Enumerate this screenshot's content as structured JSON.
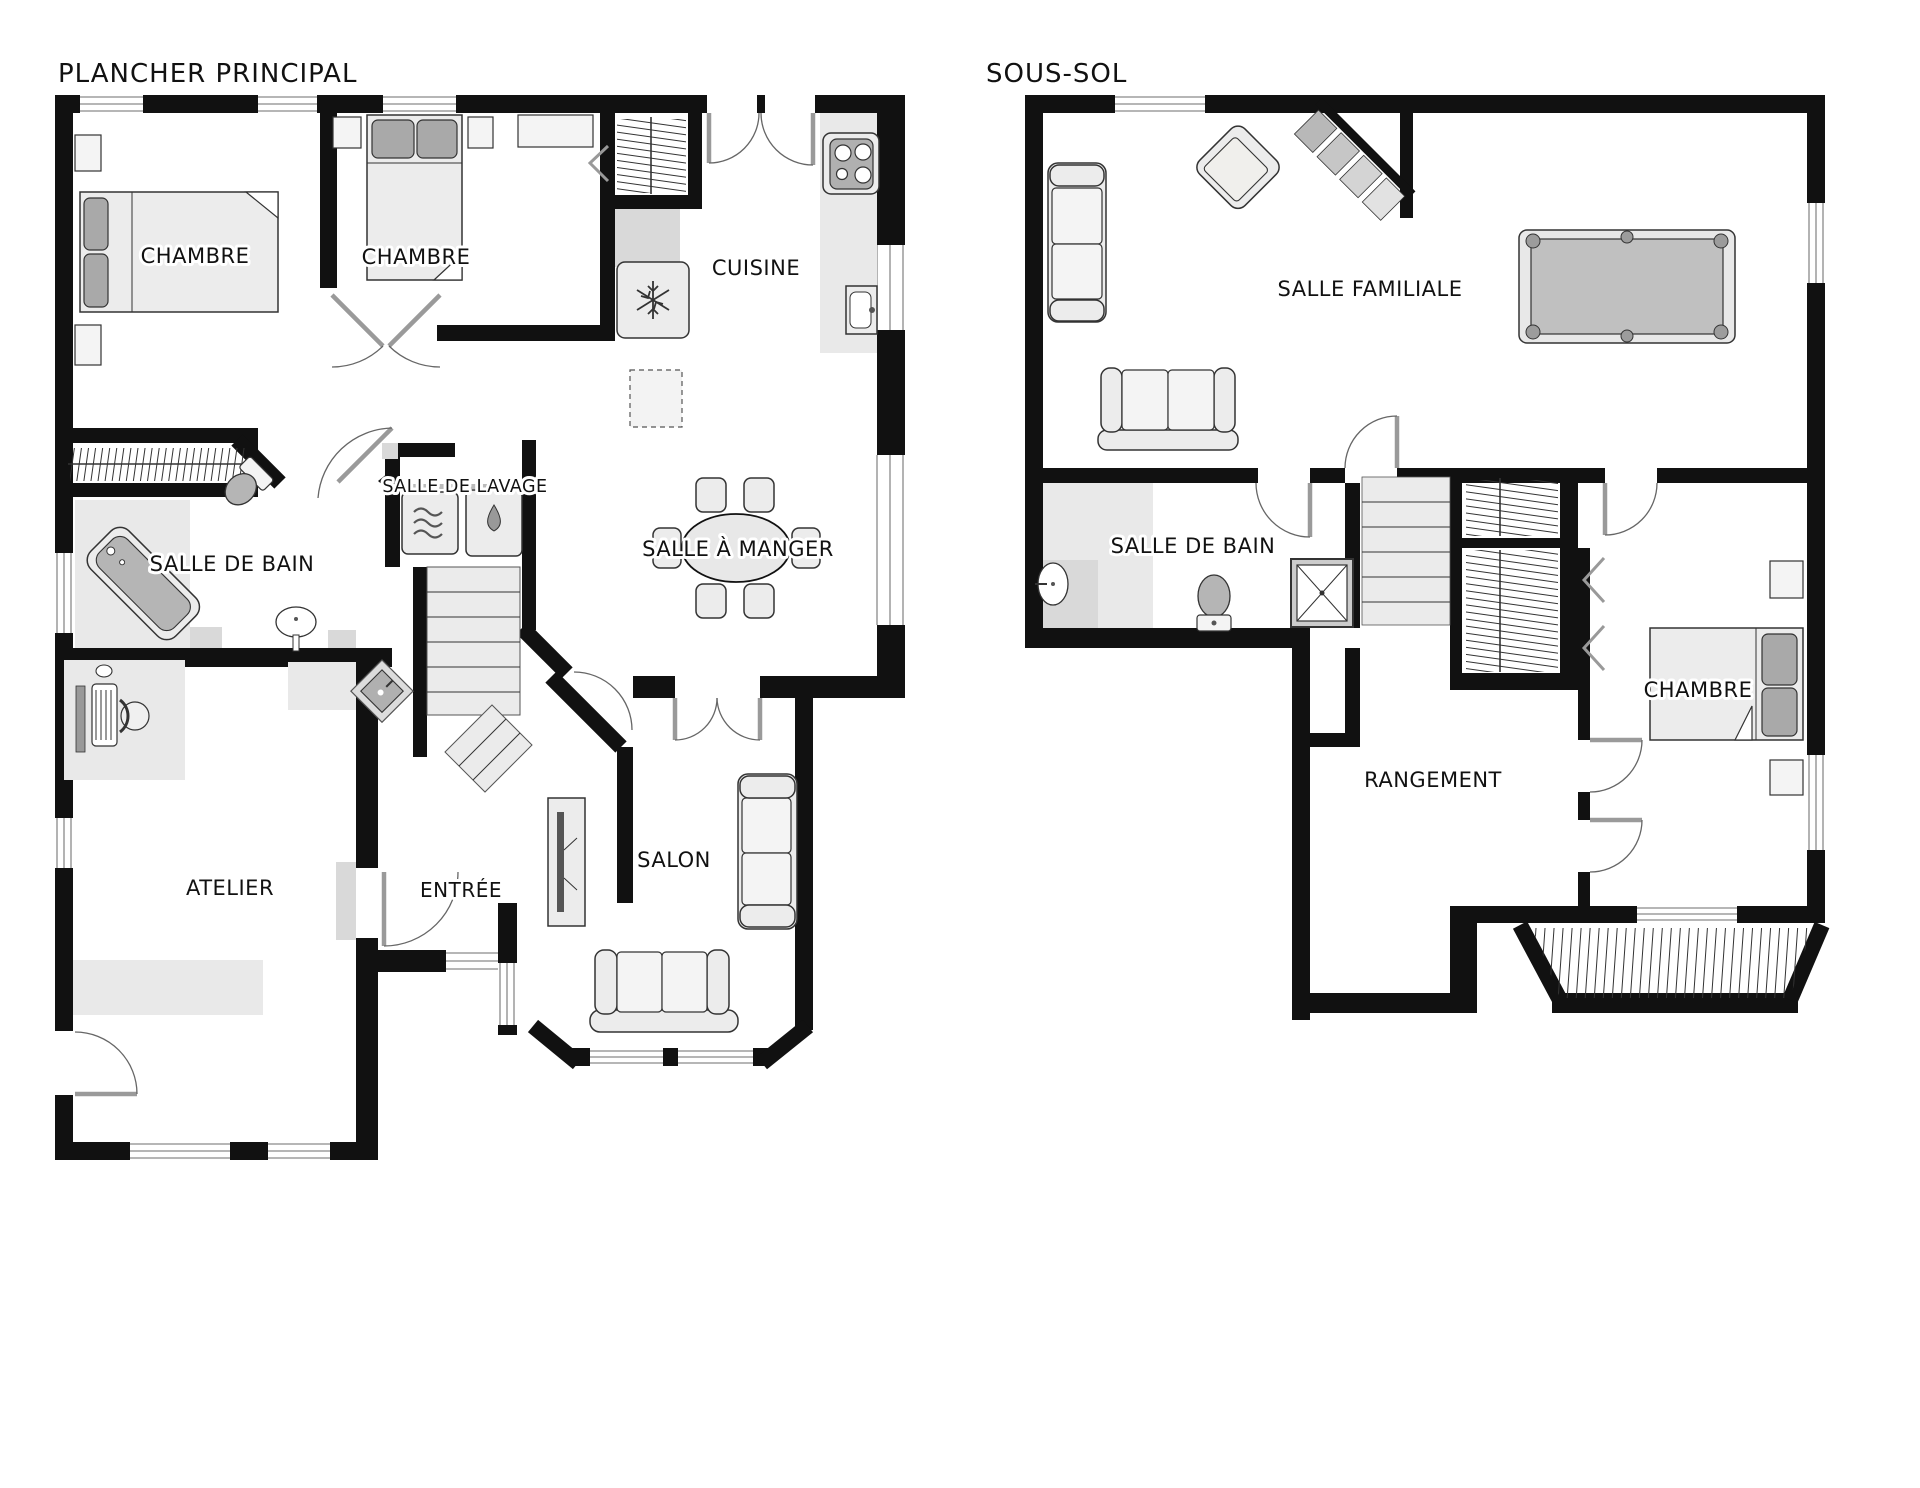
{
  "document_type": "floor-plan",
  "plans": [
    {
      "title": "PLANCHER PRINCIPAL",
      "rooms": [
        {
          "label": "CHAMBRE"
        },
        {
          "label": "CHAMBRE"
        },
        {
          "label": "CUISINE"
        },
        {
          "label": "SALLE DE LAVAGE"
        },
        {
          "label": "SALLE À MANGER"
        },
        {
          "label": "SALLE DE BAIN"
        },
        {
          "label": "ATELIER"
        },
        {
          "label": "ENTRÉE"
        },
        {
          "label": "SALON"
        }
      ],
      "fixtures": [
        "bed-icon",
        "bed-icon",
        "stove-icon",
        "fridge-snowflake-icon",
        "washer-waves-icon",
        "dryer-drop-icon",
        "bathtub-icon",
        "toilet-icon",
        "sink-icon",
        "dining-table-icon",
        "sofa-icon",
        "tv-unit-icon",
        "desk-icon",
        "stairs-icon",
        "closet-rod-icon"
      ]
    },
    {
      "title": "SOUS-SOL",
      "rooms": [
        {
          "label": "SALLE FAMILIALE"
        },
        {
          "label": "SALLE DE BAIN"
        },
        {
          "label": "RANGEMENT"
        },
        {
          "label": "CHAMBRE"
        }
      ],
      "fixtures": [
        "sofa-icon",
        "armchair-icon",
        "pool-table-icon",
        "stairs-icon",
        "shower-icon",
        "toilet-icon",
        "sink-icon",
        "bed-icon",
        "closet-rod-icon",
        "deck-icon"
      ]
    }
  ],
  "colors": {
    "wall": "#111111",
    "furniture_fill": "#ececec",
    "accent_gray": "#a9a9a9",
    "floor_patch": "#e9e9e9",
    "pool_felt": "#c0c0c0",
    "background": "#ffffff"
  }
}
